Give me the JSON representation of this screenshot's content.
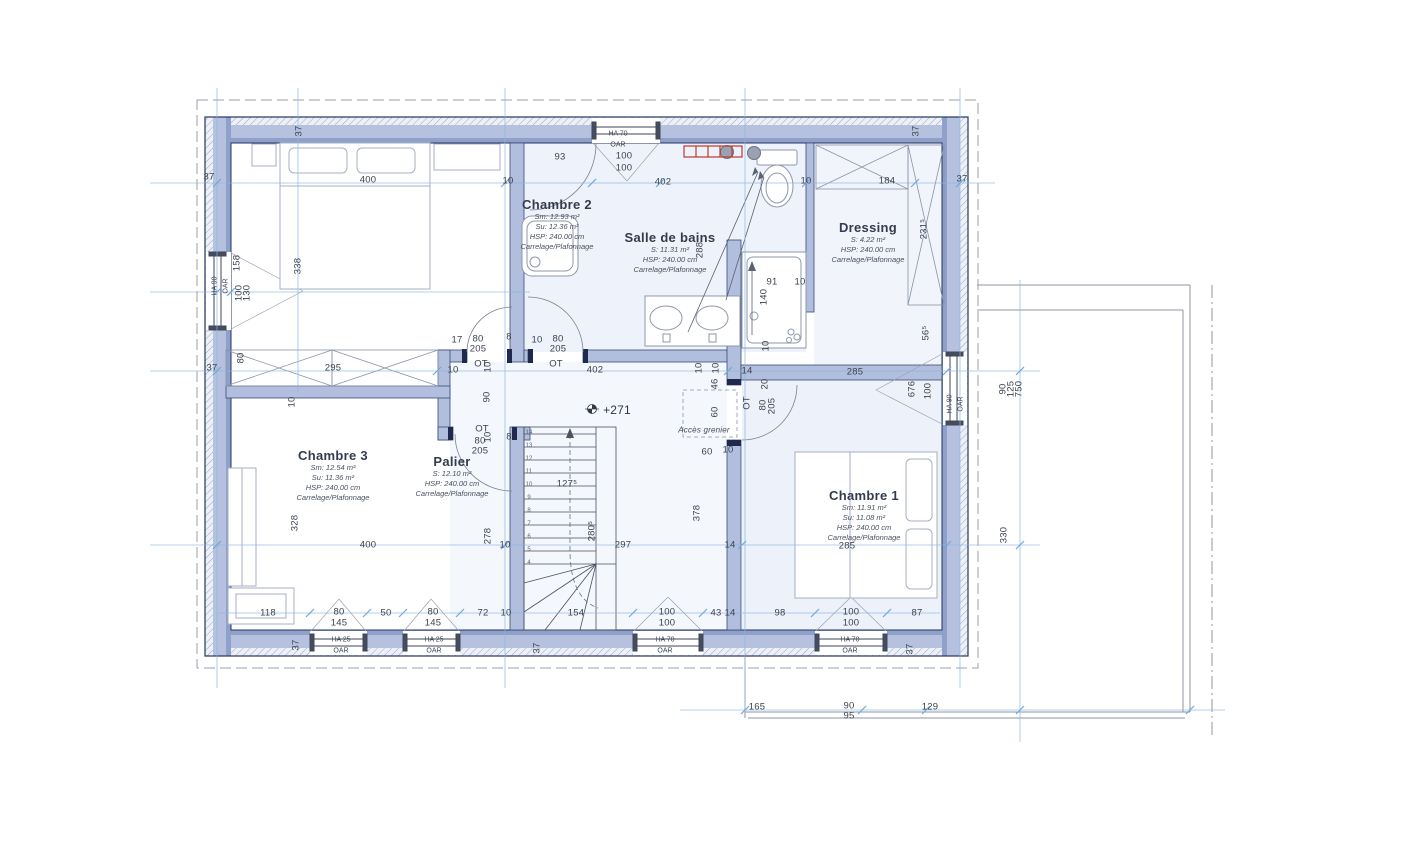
{
  "plan": {
    "rooms": [
      {
        "name": "Chambre 2",
        "x": 557,
        "y": 197,
        "lines": [
          "Sm: 12.93 m²",
          "Su: 12.36 m²",
          "HSP: 240.00 cm",
          "Carrelage/Plafonnage"
        ]
      },
      {
        "name": "Salle de bains",
        "x": 670,
        "y": 230,
        "lines": [
          "S: 11.31 m²",
          "HSP: 240.00 cm",
          "Carrelage/Plafonnage"
        ]
      },
      {
        "name": "Dressing",
        "x": 868,
        "y": 220,
        "lines": [
          "S: 4.22 m²",
          "HSP: 240.00 cm",
          "Carrelage/Plafonnage"
        ]
      },
      {
        "name": "Chambre 3",
        "x": 333,
        "y": 448,
        "lines": [
          "Sm: 12.54 m²",
          "Su: 11.36 m²",
          "HSP: 240.00 cm",
          "Carrelage/Plafonnage"
        ]
      },
      {
        "name": "Palier",
        "x": 452,
        "y": 454,
        "lines": [
          "S: 12.10 m²",
          "HSP: 240.00 cm",
          "Carrelage/Plafonnage"
        ]
      },
      {
        "name": "Chambre 1",
        "x": 864,
        "y": 488,
        "lines": [
          "Sm: 11.91 m²",
          "Su: 11.08 m²",
          "HSP: 240.00 cm",
          "Carrelage/Plafonnage"
        ]
      }
    ],
    "window_labels": [
      {
        "l1": "HA  70",
        "l2": "OAR",
        "x": 618,
        "y": 140
      },
      {
        "l1": "HA  90",
        "l2": "OAR",
        "x": 221,
        "y": 286,
        "r": 1
      },
      {
        "l1": "HA  90",
        "l2": "OAR",
        "x": 956,
        "y": 404,
        "r": 1
      },
      {
        "l1": "HA  25",
        "l2": "OAR",
        "x": 341,
        "y": 646
      },
      {
        "l1": "HA  25",
        "l2": "OAR",
        "x": 434,
        "y": 646
      },
      {
        "l1": "HA  70",
        "l2": "OAR",
        "x": 665,
        "y": 646
      },
      {
        "l1": "HA  70",
        "l2": "OAR",
        "x": 850,
        "y": 646
      }
    ],
    "stair_numbers": [
      "14",
      "13",
      "12",
      "11",
      "10",
      "9",
      "8",
      "7",
      "6",
      "5",
      "4"
    ],
    "dimensions": [
      {
        "t": "37",
        "x": 299,
        "y": 131,
        "r": 1
      },
      {
        "t": "37",
        "x": 916,
        "y": 131,
        "r": 1
      },
      {
        "t": "37",
        "x": 209,
        "y": 177
      },
      {
        "t": "37",
        "x": 962,
        "y": 179
      },
      {
        "t": "400",
        "x": 368,
        "y": 180
      },
      {
        "t": "10",
        "x": 508,
        "y": 181
      },
      {
        "t": "93",
        "x": 560,
        "y": 157
      },
      {
        "t": "100",
        "x": 624,
        "y": 156
      },
      {
        "t": "100",
        "x": 624,
        "y": 168
      },
      {
        "t": "402",
        "x": 663,
        "y": 182
      },
      {
        "t": "10",
        "x": 806,
        "y": 181
      },
      {
        "t": "184",
        "x": 887,
        "y": 181
      },
      {
        "t": "158",
        "x": 237,
        "y": 263,
        "r": 1
      },
      {
        "t": "338",
        "x": 298,
        "y": 266,
        "r": 1
      },
      {
        "t": "100",
        "x": 239,
        "y": 293,
        "r": 1
      },
      {
        "t": "130",
        "x": 247,
        "y": 293,
        "r": 1
      },
      {
        "t": "288",
        "x": 700,
        "y": 250,
        "r": 1
      },
      {
        "t": "231⁵",
        "x": 924,
        "y": 229,
        "r": 1
      },
      {
        "t": "56⁵",
        "x": 926,
        "y": 333,
        "r": 1
      },
      {
        "t": "91",
        "x": 772,
        "y": 282
      },
      {
        "t": "10",
        "x": 800,
        "y": 282
      },
      {
        "t": "140",
        "x": 764,
        "y": 297,
        "r": 1
      },
      {
        "t": "10",
        "x": 766,
        "y": 346,
        "r": 1
      },
      {
        "t": "80",
        "x": 241,
        "y": 358,
        "r": 1
      },
      {
        "t": "37",
        "x": 212,
        "y": 368
      },
      {
        "t": "295",
        "x": 333,
        "y": 368
      },
      {
        "t": "10",
        "x": 292,
        "y": 402,
        "r": 1
      },
      {
        "t": "17",
        "x": 457,
        "y": 340
      },
      {
        "t": "80",
        "x": 478,
        "y": 339
      },
      {
        "t": "205",
        "x": 478,
        "y": 349
      },
      {
        "t": "8",
        "x": 509,
        "y": 337
      },
      {
        "t": "10",
        "x": 537,
        "y": 340
      },
      {
        "t": "80",
        "x": 558,
        "y": 339
      },
      {
        "t": "205",
        "x": 558,
        "y": 349
      },
      {
        "t": "OT",
        "x": 481,
        "y": 364
      },
      {
        "t": "10",
        "x": 488,
        "y": 367,
        "r": 1
      },
      {
        "t": "OT",
        "x": 556,
        "y": 364
      },
      {
        "t": "10",
        "x": 453,
        "y": 370
      },
      {
        "t": "402",
        "x": 595,
        "y": 370
      },
      {
        "t": "10",
        "x": 699,
        "y": 368,
        "r": 1
      },
      {
        "t": "10",
        "x": 716,
        "y": 368,
        "r": 1
      },
      {
        "t": "14",
        "x": 747,
        "y": 371
      },
      {
        "t": "285",
        "x": 855,
        "y": 372
      },
      {
        "t": "90",
        "x": 487,
        "y": 397,
        "r": 1
      },
      {
        "t": "46",
        "x": 715,
        "y": 384,
        "r": 1
      },
      {
        "t": "20",
        "x": 765,
        "y": 384,
        "r": 1
      },
      {
        "t": "OT",
        "x": 747,
        "y": 403,
        "r": 1
      },
      {
        "t": "80",
        "x": 763,
        "y": 405,
        "r": 1
      },
      {
        "t": "205",
        "x": 772,
        "y": 406,
        "r": 1
      },
      {
        "t": "60",
        "x": 715,
        "y": 412,
        "r": 1
      },
      {
        "t": "+271",
        "x": 617,
        "y": 410,
        "cls": "lvl"
      },
      {
        "t": "Accès grenier",
        "x": 704,
        "y": 430,
        "cls": "it"
      },
      {
        "t": "OT",
        "x": 482,
        "y": 429
      },
      {
        "t": "80",
        "x": 480,
        "y": 441
      },
      {
        "t": "205",
        "x": 480,
        "y": 451
      },
      {
        "t": "8",
        "x": 509,
        "y": 437
      },
      {
        "t": "10",
        "x": 488,
        "y": 437,
        "r": 1
      },
      {
        "t": "60",
        "x": 707,
        "y": 452
      },
      {
        "t": "10",
        "x": 728,
        "y": 450
      },
      {
        "t": "676",
        "x": 912,
        "y": 389,
        "r": 1
      },
      {
        "t": "100",
        "x": 928,
        "y": 391,
        "r": 1
      },
      {
        "t": "90",
        "x": 1003,
        "y": 389,
        "r": 1
      },
      {
        "t": "125",
        "x": 1011,
        "y": 389,
        "r": 1
      },
      {
        "t": "750",
        "x": 1019,
        "y": 389,
        "r": 1
      },
      {
        "t": "127⁵",
        "x": 567,
        "y": 484
      },
      {
        "t": "280⁵",
        "x": 592,
        "y": 531,
        "r": 1
      },
      {
        "t": "297",
        "x": 623,
        "y": 545
      },
      {
        "t": "378",
        "x": 697,
        "y": 513,
        "r": 1
      },
      {
        "t": "278",
        "x": 488,
        "y": 536,
        "r": 1
      },
      {
        "t": "328",
        "x": 295,
        "y": 523,
        "r": 1
      },
      {
        "t": "400",
        "x": 368,
        "y": 545
      },
      {
        "t": "10",
        "x": 505,
        "y": 545
      },
      {
        "t": "14",
        "x": 730,
        "y": 545
      },
      {
        "t": "285",
        "x": 847,
        "y": 546
      },
      {
        "t": "330",
        "x": 1004,
        "y": 535,
        "r": 1
      },
      {
        "t": "118",
        "x": 268,
        "y": 613
      },
      {
        "t": "80",
        "x": 339,
        "y": 612
      },
      {
        "t": "145",
        "x": 339,
        "y": 623
      },
      {
        "t": "50",
        "x": 386,
        "y": 613
      },
      {
        "t": "80",
        "x": 433,
        "y": 612
      },
      {
        "t": "145",
        "x": 433,
        "y": 623
      },
      {
        "t": "72",
        "x": 483,
        "y": 613
      },
      {
        "t": "10",
        "x": 506,
        "y": 613
      },
      {
        "t": "154",
        "x": 576,
        "y": 613
      },
      {
        "t": "100",
        "x": 667,
        "y": 612
      },
      {
        "t": "100",
        "x": 667,
        "y": 623
      },
      {
        "t": "43",
        "x": 716,
        "y": 613
      },
      {
        "t": "14",
        "x": 730,
        "y": 613
      },
      {
        "t": "98",
        "x": 780,
        "y": 613
      },
      {
        "t": "100",
        "x": 851,
        "y": 612
      },
      {
        "t": "100",
        "x": 851,
        "y": 623
      },
      {
        "t": "87",
        "x": 917,
        "y": 613
      },
      {
        "t": "37",
        "x": 296,
        "y": 645,
        "r": 1
      },
      {
        "t": "37",
        "x": 537,
        "y": 648,
        "r": 1
      },
      {
        "t": "37",
        "x": 910,
        "y": 649,
        "r": 1
      },
      {
        "t": "165",
        "x": 757,
        "y": 707
      },
      {
        "t": "90",
        "x": 849,
        "y": 706
      },
      {
        "t": "95",
        "x": 849,
        "y": 716
      },
      {
        "t": "129",
        "x": 930,
        "y": 707
      }
    ],
    "colors": {
      "wall_fill": "#b6c1df",
      "wall_stripe": "#8fa0ca",
      "wall_edge": "#26355f",
      "dim_line": "#8ab6e2",
      "radiator": "#c0392b",
      "floor_tint": "#eef2fa"
    }
  }
}
